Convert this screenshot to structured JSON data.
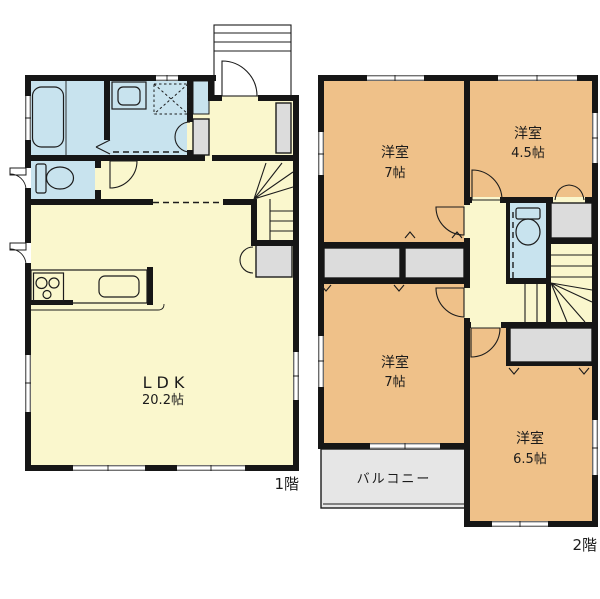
{
  "floor1": {
    "label": "1階",
    "ldk_name": "LDK",
    "ldk_size": "20.2帖"
  },
  "floor2": {
    "label": "2階",
    "room_nw_name": "洋室",
    "room_nw_size": "7帖",
    "room_ne_name": "洋室",
    "room_ne_size": "4.5帖",
    "room_sw_name": "洋室",
    "room_sw_size": "7帖",
    "room_se_name": "洋室",
    "room_se_size": "6.5帖",
    "balcony_label": "バルコニー"
  },
  "colors": {
    "room_yellow": "#FAF7CD",
    "room_orange": "#EFC189",
    "wet_blue": "#C8E3EE",
    "closet_gray": "#DCDCDC",
    "balcony_gray": "#E6E6E6",
    "wall": "#161616"
  }
}
